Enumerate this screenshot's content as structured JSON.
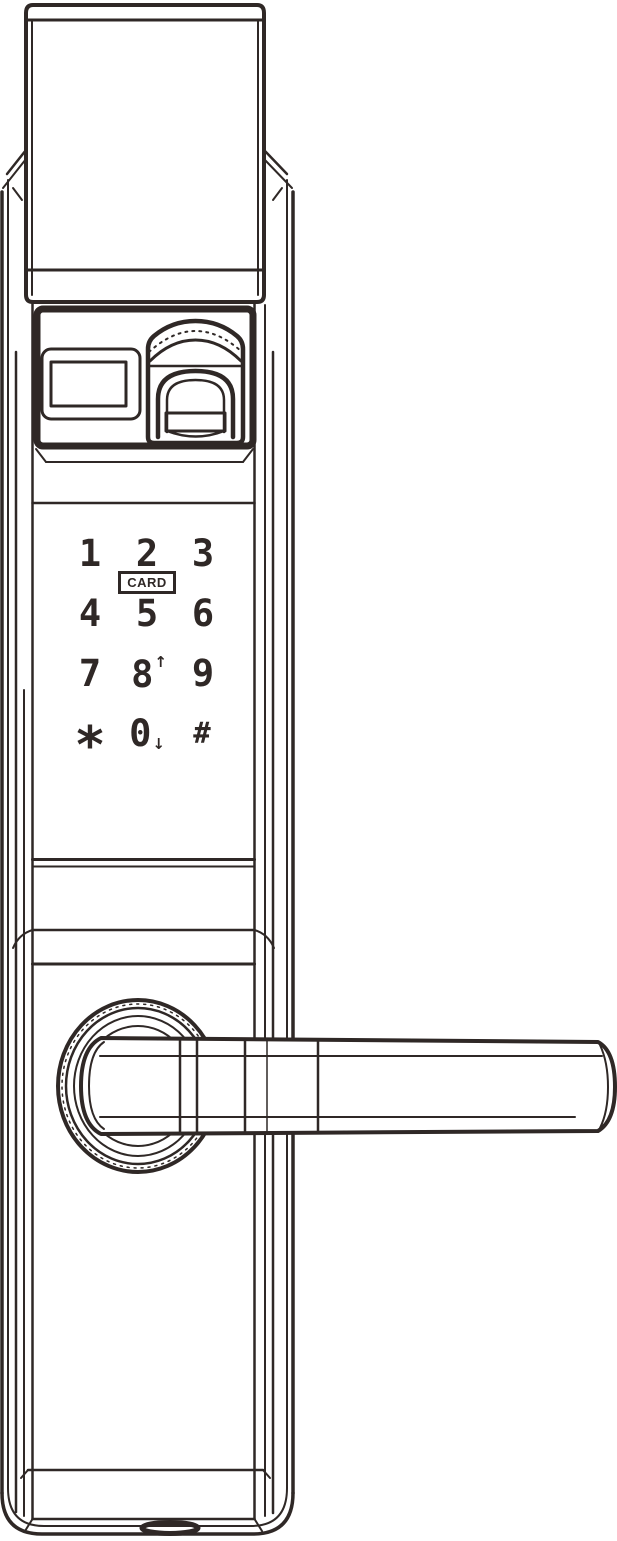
{
  "colors": {
    "line": "#2f2826",
    "background": "#ffffff"
  },
  "keypad": {
    "card_label": "CARD",
    "keys": [
      {
        "label": "1"
      },
      {
        "label": "2"
      },
      {
        "label": "3"
      },
      {
        "label": "4"
      },
      {
        "label": "5"
      },
      {
        "label": "6"
      },
      {
        "label": "7"
      },
      {
        "label": "8",
        "arrow": "↑"
      },
      {
        "label": "9"
      },
      {
        "label": "*"
      },
      {
        "label": "0",
        "arrow": "↓"
      },
      {
        "label": "#"
      }
    ]
  }
}
